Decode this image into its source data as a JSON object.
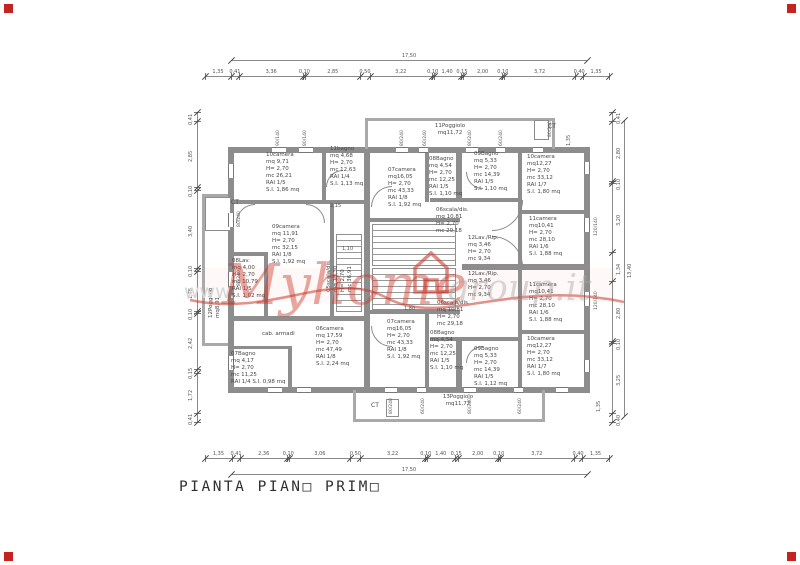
{
  "page": {
    "title": "PIANTA PIAN□ PRIM□"
  },
  "watermark": {
    "www": "www.",
    "brand": "Myhome",
    "suffix": "group.it"
  },
  "dimensions": {
    "top": {
      "total": "17,50",
      "segments": [
        "1,35",
        "0,41",
        "3,36",
        "0,10",
        "2,85",
        "0,50",
        "3,22",
        "0,10",
        "1,40",
        "0,15",
        "2,00",
        "0,10",
        "3,72",
        "0,40",
        "1,35"
      ]
    },
    "bottom": {
      "total": "17,50",
      "segments": [
        "1,35",
        "0,41",
        "2,36",
        "0,10",
        "3,06",
        "0,50",
        "3,22",
        "0,10",
        "1,40",
        "0,15",
        "2,00",
        "0,10",
        "3,72",
        "0,40",
        "1,35"
      ]
    },
    "left": {
      "segments": [
        "0,41",
        "2,85",
        "0,10",
        "3,40",
        "0,10",
        "1,75",
        "0,10",
        "2,42",
        "0,15",
        "1,72",
        "0,41"
      ]
    },
    "right": {
      "total": "13,40",
      "segments": [
        "0,41",
        "2,80",
        "0,10",
        "3,20",
        "1,34",
        "2,80",
        "0,10",
        "3,25",
        "0,40"
      ]
    },
    "interior": [
      {
        "text": "2,15"
      },
      {
        "text": "1,10"
      },
      {
        "text": "1,80"
      },
      {
        "text": "1,35"
      },
      {
        "text": "1,35"
      }
    ]
  },
  "rooms": [
    {
      "id": "room-10camera-tl",
      "lines": [
        "10camera",
        "mq 9,71",
        "H= 2,70",
        "mc 26,21",
        "RAI 1/5",
        "S.I. 1,86 mq"
      ]
    },
    {
      "id": "room-11bagno",
      "lines": [
        "11bagno",
        "mq 4,68",
        "H= 2,70",
        "mc 12,63",
        "RAI 1/4",
        "S.I. 1,13 mq"
      ]
    },
    {
      "id": "room-07camera-top",
      "lines": [
        "07camera",
        "mq16,05",
        "H= 2,70",
        "mc 43,33",
        "RAI 1/8",
        "S.I. 1,92 mq"
      ]
    },
    {
      "id": "room-08bagno-top",
      "lines": [
        "08Bagno",
        "mq 4,54",
        "H= 2,70",
        "mc 12,25",
        "RAI 1/5",
        "S.I. 1,10 mq"
      ]
    },
    {
      "id": "room-09bagno-top",
      "lines": [
        "09Bagno",
        "mq 5,33",
        "H= 2,70",
        "mc 14,39",
        "RAI 1/5",
        "S.I. 1,10 mq"
      ]
    },
    {
      "id": "room-10camera-tr",
      "lines": [
        "10camera",
        "mq12,27",
        "H= 2,70",
        "mc 33,12",
        "RAI 1/7",
        "S.I. 1,80 mq"
      ]
    },
    {
      "id": "room-06scala-top",
      "lines": [
        "06scala/dis.",
        "mq 10,81",
        "H= 2,70",
        "mc 29,18"
      ]
    },
    {
      "id": "room-12lav-top",
      "lines": [
        "12Lav./Rip.",
        "mq 3,46",
        "H= 2,70",
        "mc 9,34"
      ]
    },
    {
      "id": "room-11camera-top",
      "lines": [
        "11camera",
        "mq10,41",
        "H= 2,70",
        "mc 28,10",
        "RAI 1/6",
        "S.I. 1,88 mq"
      ]
    },
    {
      "id": "room-09camera",
      "lines": [
        "09camera",
        "mq 11,91",
        "H= 2,70",
        "mc 32,15",
        "RAI 1/8",
        "S.I. 1,92 mq"
      ]
    },
    {
      "id": "room-05scala",
      "lines": [
        "05scala/dis.",
        "mq 13,30",
        "H= 2,70",
        "mc 36,91"
      ]
    },
    {
      "id": "room-08lav",
      "lines": [
        "08Lav.",
        "mq 4,00",
        "H= 2,70",
        "mc 10,79",
        "RAI 1/5",
        "S.I. 1,02 mq"
      ]
    },
    {
      "id": "room-cab-armadi",
      "lines": [
        "cab. armadi"
      ]
    },
    {
      "id": "room-06camera",
      "lines": [
        "06camera",
        "mq 17,59",
        "H= 2,70",
        "mc 47,49",
        "RAI 1/8",
        "S.I. 2,24 mq"
      ]
    },
    {
      "id": "room-07bagno",
      "lines": [
        "07Bagno",
        "mq 4,17",
        "H= 2,70",
        "mc 11,25",
        "RAI 1/4 S.I. 0,98 mq"
      ]
    },
    {
      "id": "room-07camera-bottom",
      "lines": [
        "07camera",
        "mq16,05",
        "H= 2,70",
        "mc 43,33",
        "RAI 1/8",
        "S.I. 1,92 mq"
      ]
    },
    {
      "id": "room-06scala-bottom",
      "lines": [
        "06scala/dis.",
        "mq 10,81",
        "H= 2,70",
        "mc 29,18"
      ]
    },
    {
      "id": "room-08bagno-bottom",
      "lines": [
        "08Bagno",
        "mq 4,54",
        "H= 2,70",
        "mc 12,25",
        "RAI 1/5",
        "S.I. 1,10 mq"
      ]
    },
    {
      "id": "room-09bagno-bottom",
      "lines": [
        "09Bagno",
        "mq 5,33",
        "H= 2,70",
        "mc 14,39",
        "RAI 1/5",
        "S.I. 1,12 mq"
      ]
    },
    {
      "id": "room-10camera-br",
      "lines": [
        "10camera",
        "mq12,27",
        "H= 2,70",
        "mc 33,12",
        "RAI 1/7",
        "S.I. 1,80 mq"
      ]
    },
    {
      "id": "room-11camera-bottom",
      "lines": [
        "11camera",
        "mq10,41",
        "H= 2,70",
        "mc 28,10",
        "RAI 1/6",
        "S.I. 1,88 mq"
      ]
    },
    {
      "id": "room-12lav-bottom",
      "lines": [
        "12Lav./Rip.",
        "mq 3,46",
        "H= 2,70",
        "mc 9,34"
      ]
    },
    {
      "id": "balcony-11poggiolo",
      "lines": [
        "11Poggiolo",
        "mq11,72"
      ]
    },
    {
      "id": "balcony-13poggiolo",
      "lines": [
        "13Poggiolo",
        "mq11,72"
      ]
    },
    {
      "id": "balcony-12poggiolo",
      "lines": [
        "12Poggiolo",
        "mq8,91"
      ]
    }
  ],
  "ct_labels": [
    {
      "text": "CT"
    },
    {
      "text": "CT"
    },
    {
      "text": "CT"
    }
  ],
  "window_tags": [
    {
      "text": "80/240"
    },
    {
      "text": "60/240"
    },
    {
      "text": "80/240"
    },
    {
      "text": "60/240"
    },
    {
      "text": "90/140"
    },
    {
      "text": "80/140"
    },
    {
      "text": "80/240"
    },
    {
      "text": "80/240"
    },
    {
      "text": "120/140"
    },
    {
      "text": "120/140"
    },
    {
      "text": "80/240"
    },
    {
      "text": "60/240"
    },
    {
      "text": "80/240"
    },
    {
      "text": "60/240"
    },
    {
      "text": "80/240"
    }
  ],
  "colors": {
    "marker_red": "#c42320",
    "wall_gray": "#8d8d8d",
    "watermark_red": "#cb392d"
  }
}
